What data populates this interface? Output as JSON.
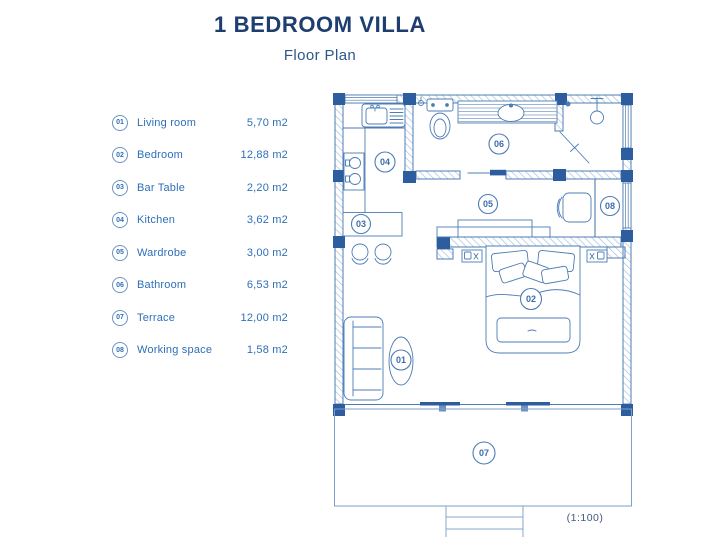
{
  "title": "1 BEDROOM VILLA",
  "subtitle": "Floor Plan",
  "legend": [
    {
      "num": "01",
      "label": "Living room",
      "area": "5,70 m2"
    },
    {
      "num": "02",
      "label": "Bedroom",
      "area": "12,88 m2"
    },
    {
      "num": "03",
      "label": "Bar Table",
      "area": "2,20 m2"
    },
    {
      "num": "04",
      "label": "Kitchen",
      "area": "3,62 m2"
    },
    {
      "num": "05",
      "label": "Wardrobe",
      "area": "3,00 m2"
    },
    {
      "num": "06",
      "label": "Bathroom",
      "area": "6,53 m2"
    },
    {
      "num": "07",
      "label": "Terrace",
      "area": "12,00 m2"
    },
    {
      "num": "08",
      "label": "Working space",
      "area": "1,58 m2"
    }
  ],
  "plan": {
    "scale": "(1:100)",
    "labels": {
      "living": "01",
      "bedroom": "02",
      "bar": "03",
      "kitchen": "04",
      "wardrobe": "05",
      "bathroom": "06",
      "terrace": "07",
      "working": "08"
    }
  },
  "colors": {
    "title": "#1d3e6e",
    "legend_text": "#2e6fb7",
    "plan_line": "#4d7cb4",
    "hatch": "#a9c2e0",
    "wall_post": "#2d5d9f"
  }
}
